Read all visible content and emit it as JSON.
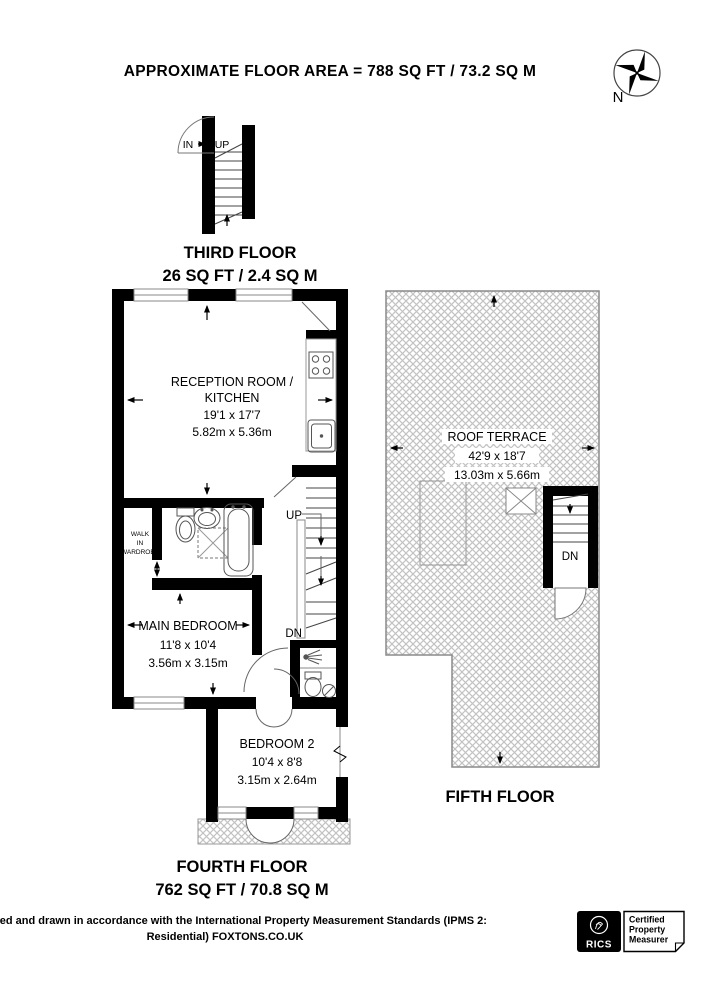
{
  "header": {
    "title": "APPROXIMATE FLOOR AREA = 788 SQ FT / 73.2 SQ M"
  },
  "compass": {
    "north_label": "N"
  },
  "floors": {
    "third": {
      "name": "THIRD FLOOR",
      "area": "26 SQ FT / 2.4 SQ M",
      "stair_in": "IN",
      "stair_up": "UP"
    },
    "fourth": {
      "name": "FOURTH FLOOR",
      "area": "762 SQ FT / 70.8 SQ M",
      "stairs": {
        "up": "UP",
        "dn": "DN"
      },
      "rooms": {
        "reception": {
          "line1": "RECEPTION ROOM /",
          "line2": "KITCHEN",
          "dims_imperial": "19'1 x 17'7",
          "dims_metric": "5.82m x 5.36m"
        },
        "wardrobe": {
          "line1": "WALK",
          "line2": "IN",
          "line3": "WARDROBE"
        },
        "main_bedroom": {
          "name": "MAIN BEDROOM",
          "dims_imperial": "11'8 x 10'4",
          "dims_metric": "3.56m x 3.15m"
        },
        "bedroom2": {
          "name": "BEDROOM 2",
          "dims_imperial": "10'4 x 8'8",
          "dims_metric": "3.15m x 2.64m"
        }
      }
    },
    "fifth": {
      "name": "FIFTH FLOOR",
      "stairs": {
        "dn": "DN"
      },
      "roof_terrace": {
        "name": "ROOF TERRACE",
        "dims_imperial": "42'9 x 18'7",
        "dims_metric": "13.03m x 5.66m"
      }
    }
  },
  "footer": {
    "line1": "Surveyed and drawn in accordance with the International Property Measurement Standards (IPMS 2:",
    "line2": "Residential) FOXTONS.CO.UK",
    "rics": {
      "brand": "RICS",
      "cert1": "Certified",
      "cert2": "Property",
      "cert3": "Measurer"
    }
  },
  "colors": {
    "wall": "#000000",
    "hatch": "#c2c2c2",
    "fixture": "#555555"
  }
}
